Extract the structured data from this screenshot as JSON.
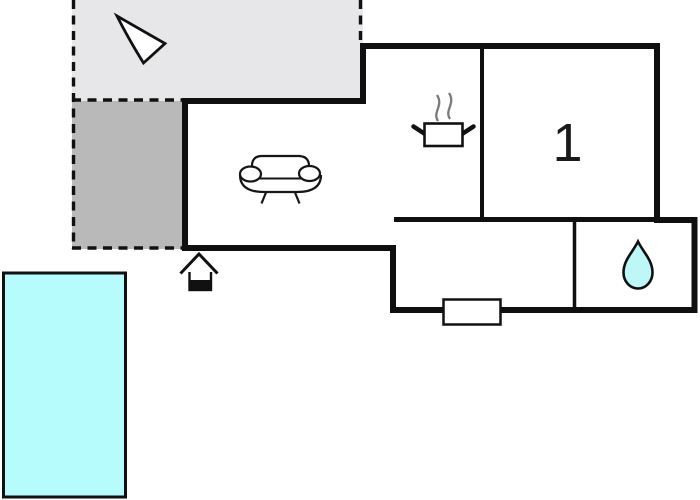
{
  "floorplan": {
    "type": "property-floor-plan",
    "rooms": {
      "bedroom_label": "1"
    },
    "colors": {
      "wall": "#0f0f0f",
      "terrace_light": "#e7e7e9",
      "terrace_dark": "#b9b9b9",
      "pool_fill": "#b6fcfc",
      "droplet_fill": "#bdf7f7",
      "steam": "#7a7a7a",
      "icon_stroke": "#161616",
      "background": "#ffffff"
    },
    "icons": {
      "north_arrow": "north-arrow",
      "sofa": "sofa",
      "stove": "steaming-pot",
      "water_drop": "water-drop",
      "entrance": "entrance-house",
      "window": "window-marker"
    }
  }
}
